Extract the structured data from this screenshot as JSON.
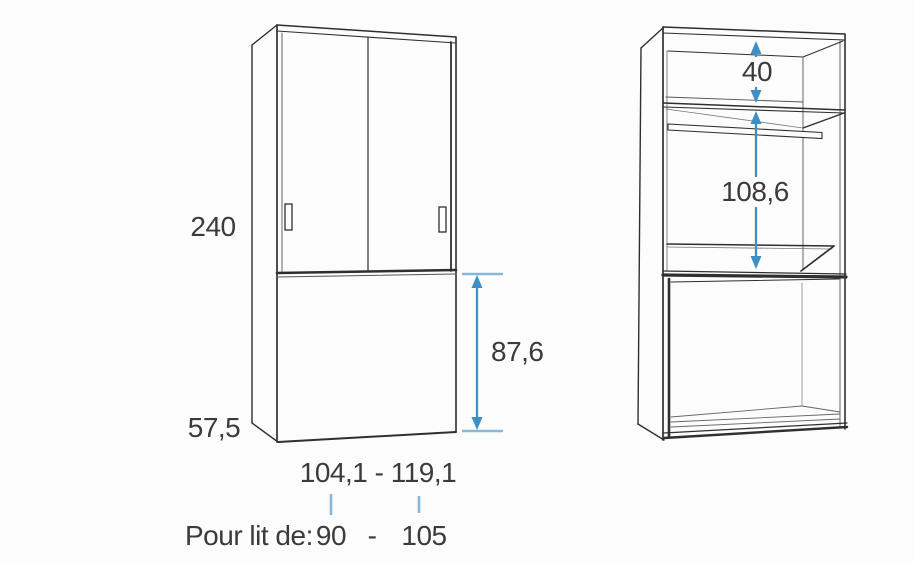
{
  "colors": {
    "background": "#fcfcfc",
    "line": "#2f2f2f",
    "arrow_blue": "#3e8fc4",
    "tick_blue": "#85b9d9",
    "text": "#3b3b3b"
  },
  "front_view": {
    "height": "240",
    "depth": "57,5",
    "bed_box_height": "87,6",
    "width_range": "104,1 - 119,1",
    "bed_note": {
      "label": "Pour lit de:",
      "min": "90",
      "dash": "-",
      "max": "105"
    }
  },
  "interior_view": {
    "top_shelf_height": "40",
    "hanging_space_height": "108,6"
  }
}
